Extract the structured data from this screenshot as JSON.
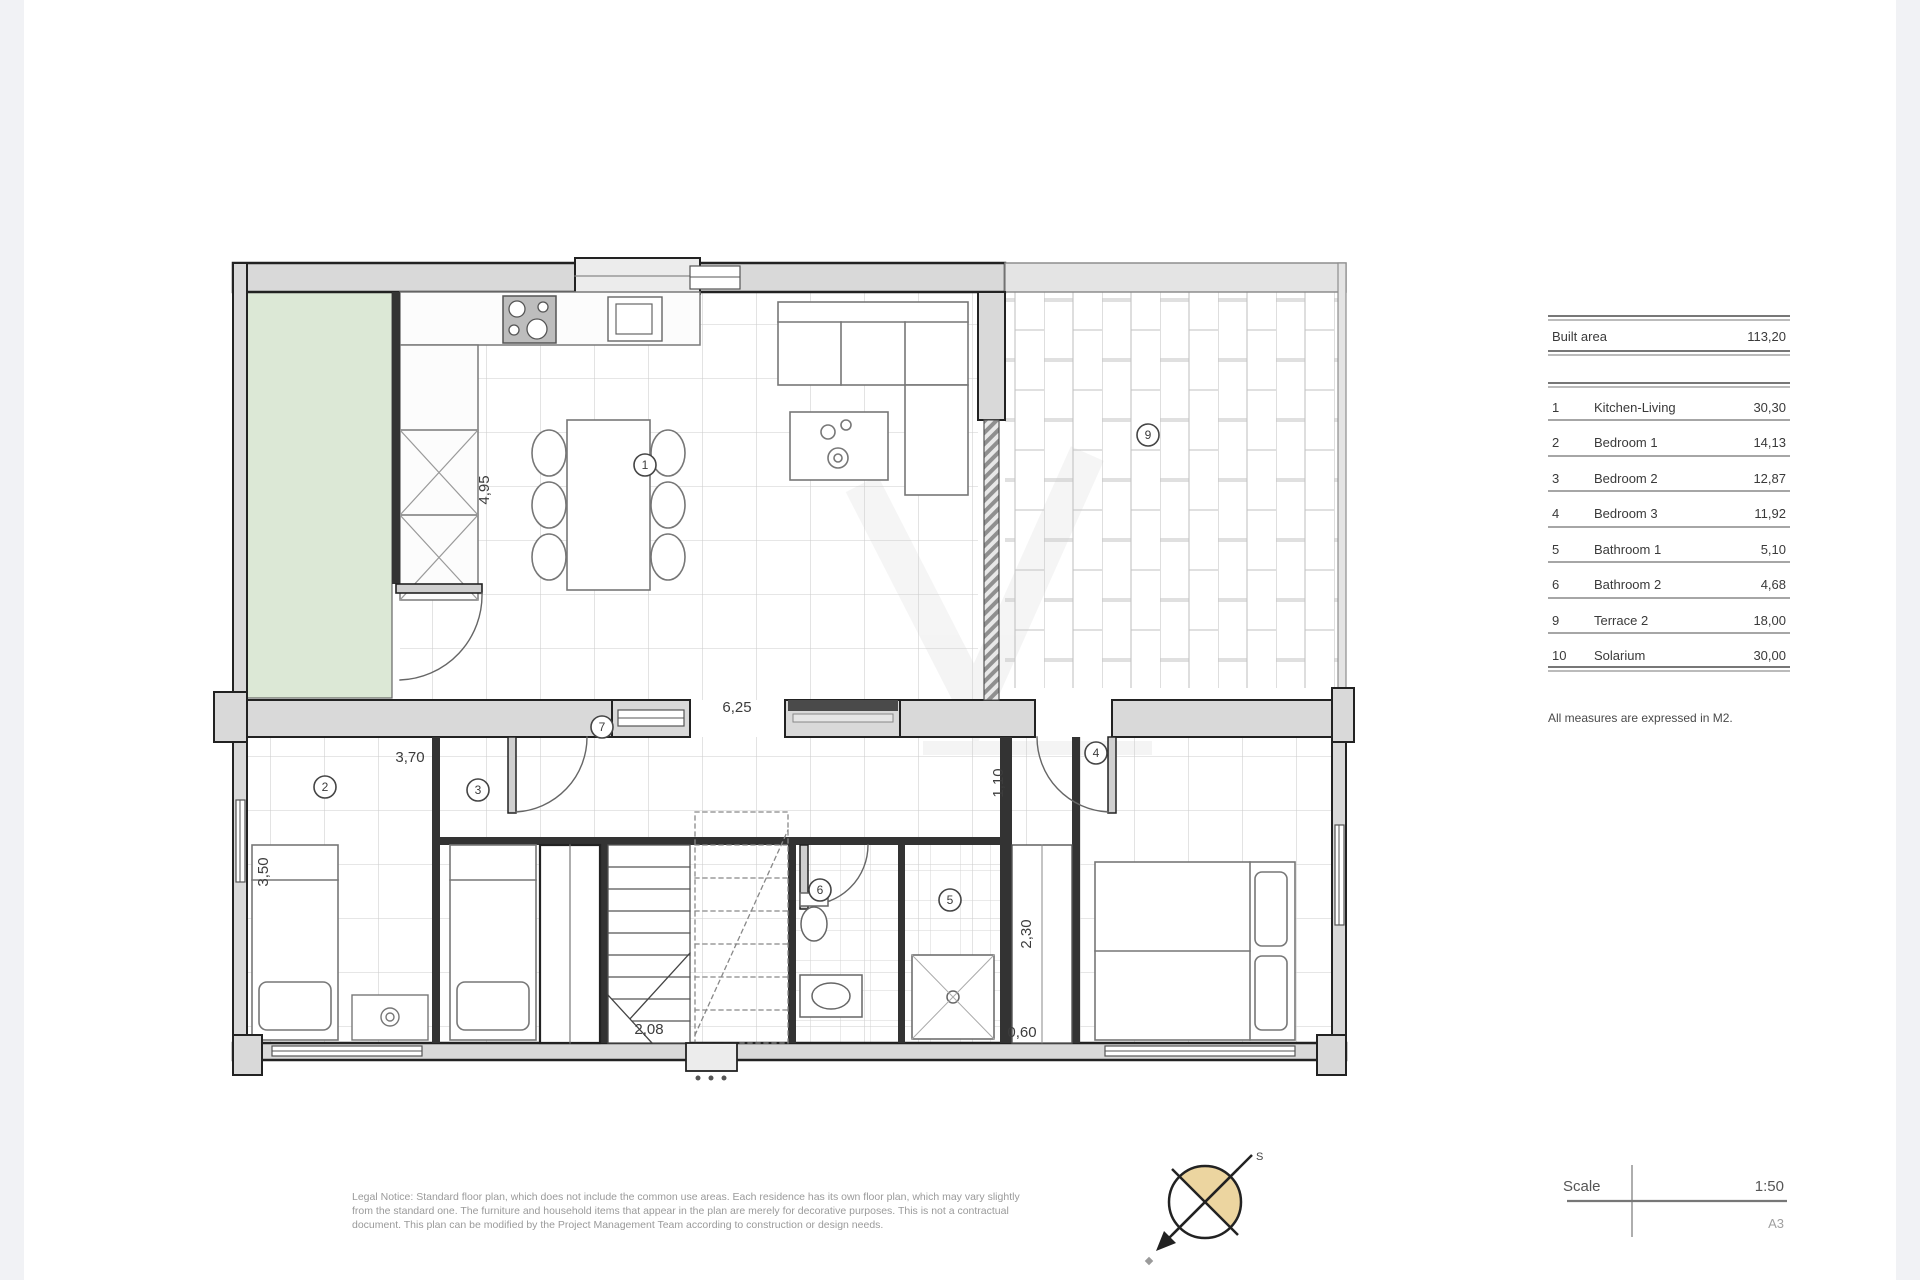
{
  "page": {
    "background": "#ffffff",
    "side_band_color": "#f1f2f5"
  },
  "plan": {
    "colors": {
      "wall_fill": "#d9d9d9",
      "wall_stroke": "#222222",
      "garden_green": "#dce8d6",
      "tile_line": "#cccccc",
      "brick_line": "#c2c2c2"
    },
    "dimensions": {
      "kitchen_height": "4,95",
      "living_width": "6,25",
      "bedroom1_width": "3,70",
      "bedroom1_height": "3,50",
      "stairs_width": "2,08",
      "hall_width": "1,10",
      "closet_height": "2,30",
      "closet_width": "0,60"
    },
    "room_numbers": {
      "kitchen_living": "1",
      "bedroom1": "2",
      "bedroom2": "3",
      "bedroom3": "4",
      "bathroom1": "5",
      "bathroom2": "6",
      "hall": "7",
      "terrace2": "9"
    }
  },
  "area_table": {
    "header": {
      "label": "Built area",
      "value": "113,20"
    },
    "rows": [
      {
        "num": "1",
        "name": "Kitchen-Living",
        "value": "30,30"
      },
      {
        "num": "2",
        "name": "Bedroom 1",
        "value": "14,13"
      },
      {
        "num": "3",
        "name": "Bedroom 2",
        "value": "12,87"
      },
      {
        "num": "4",
        "name": "Bedroom 3",
        "value": "11,92"
      },
      {
        "num": "5",
        "name": "Bathroom 1",
        "value": "5,10"
      },
      {
        "num": "6",
        "name": "Bathroom 2",
        "value": "4,68"
      },
      {
        "num": "9",
        "name": "Terrace 2",
        "value": "18,00"
      },
      {
        "num": "10",
        "name": "Solarium",
        "value": "30,00"
      }
    ],
    "footnote": "All measures are expressed in M2."
  },
  "legal_notice": {
    "line1": "Legal Notice: Standard floor plan, which does not include the common use areas. Each residence has its own floor plan, which may vary slightly",
    "line2": "from the standard one. The furniture and household items that appear in the plan are merely for decorative purposes. This is not a contractual",
    "line3": "document. This plan can be modified by the Project Management Team according to construction or design needs."
  },
  "scale_block": {
    "label": "Scale",
    "value": "1:50",
    "paper": "A3"
  },
  "compass": {
    "letter": "S"
  }
}
